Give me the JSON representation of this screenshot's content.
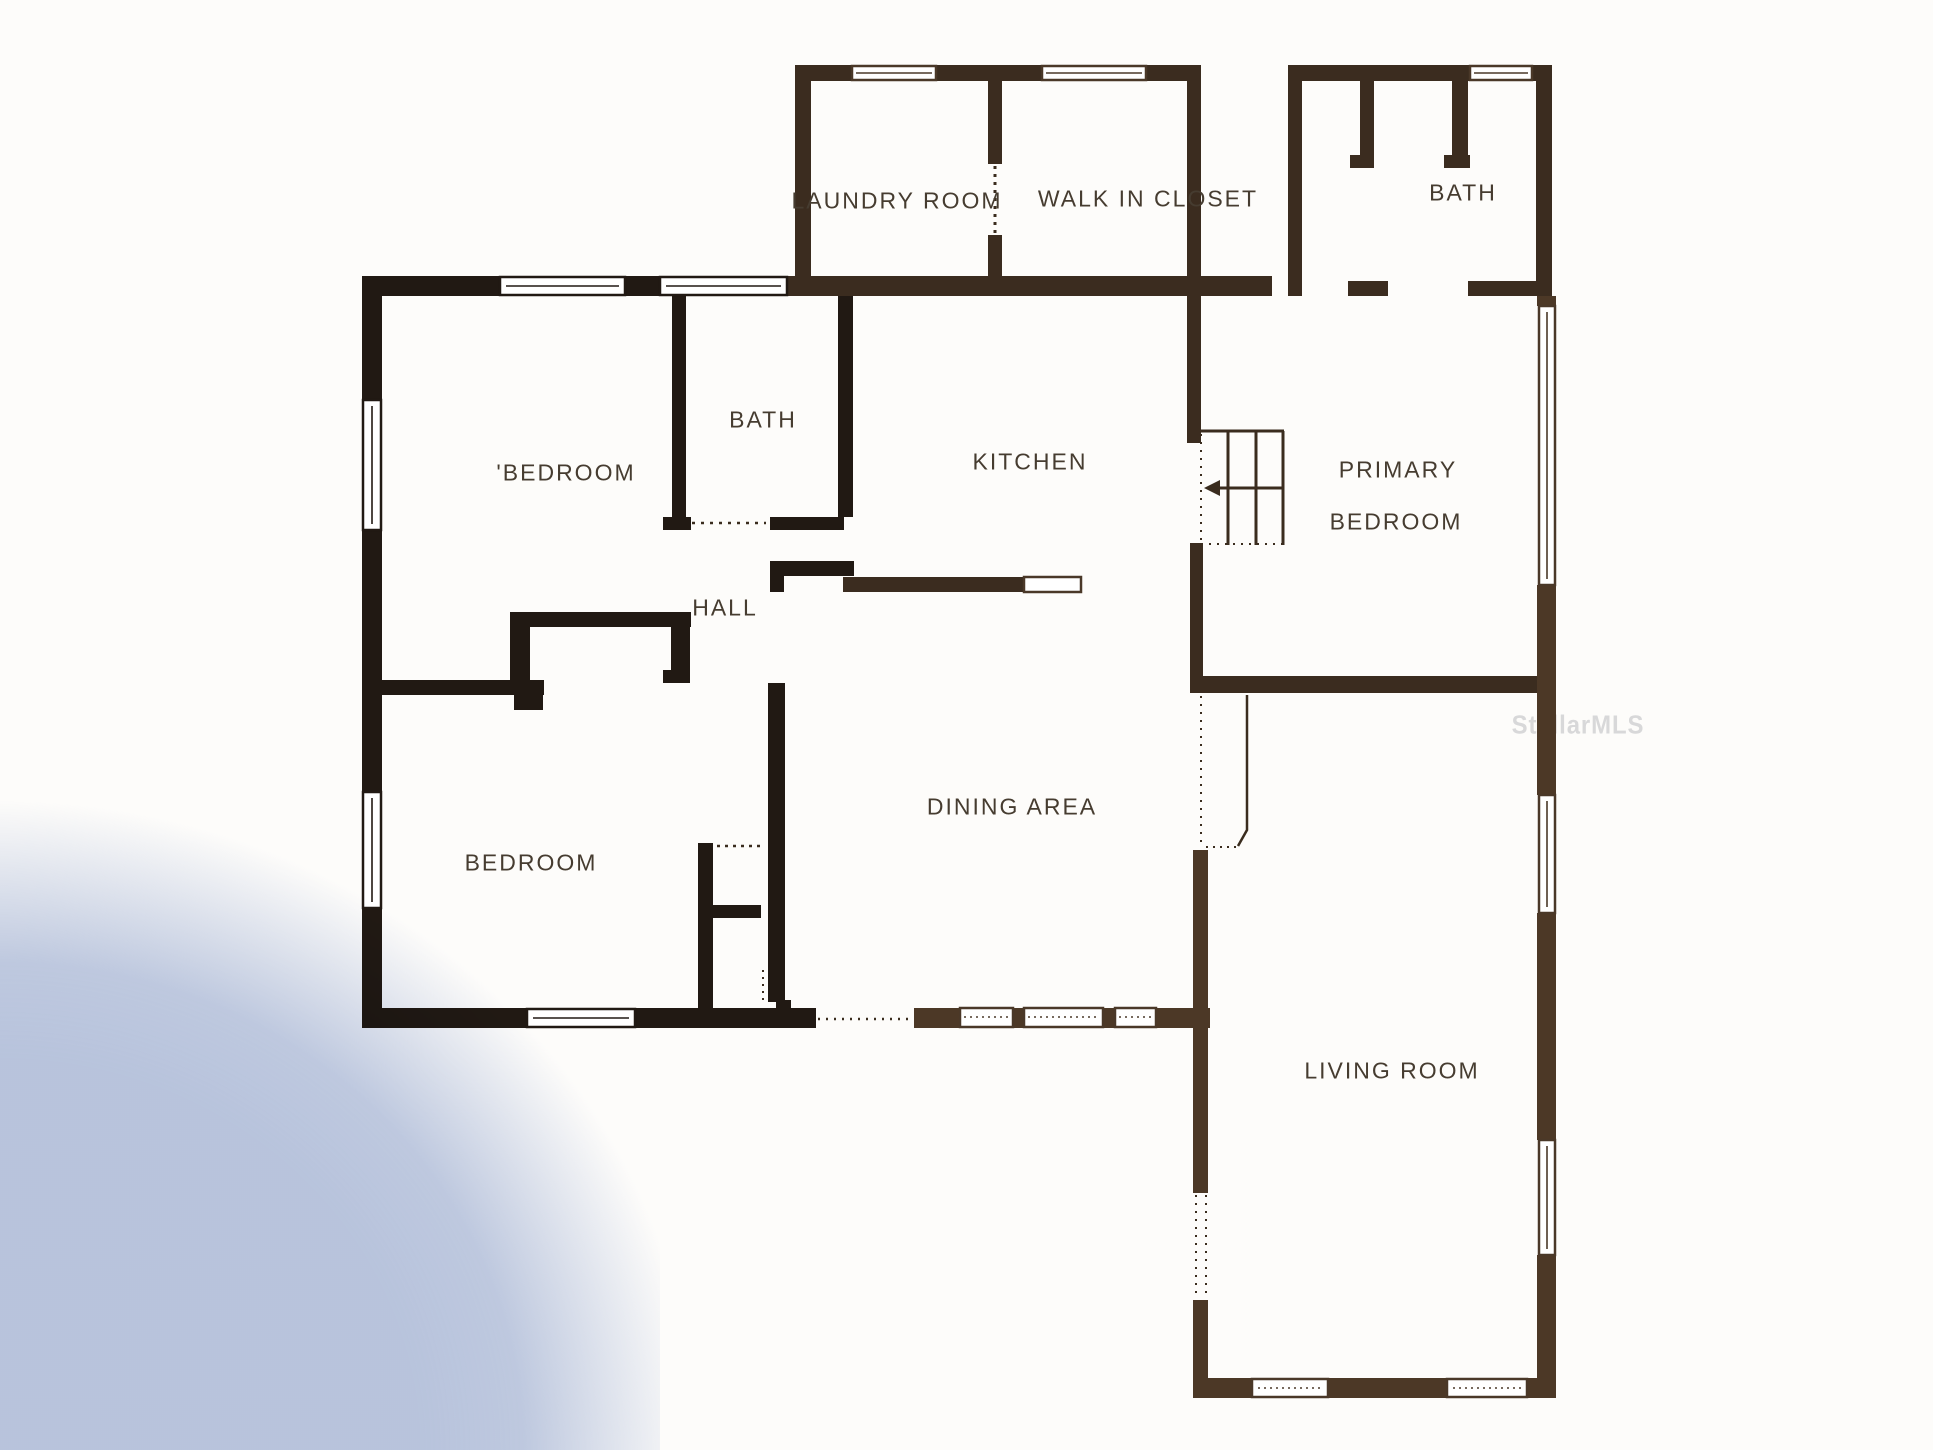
{
  "document": {
    "type": "residential-floor-plan",
    "watermark": "StellarMLS"
  },
  "rooms": {
    "laundry": {
      "label": "LAUNDRY ROOM"
    },
    "walk_in_closet": {
      "label": "WALK IN CLOSET"
    },
    "bath_upper": {
      "label": "BATH"
    },
    "bedroom_front": {
      "label": "'BEDROOM"
    },
    "bath_main": {
      "label": "BATH"
    },
    "kitchen": {
      "label": "KITCHEN"
    },
    "primary": {
      "line1": "PRIMARY",
      "line2": "BEDROOM"
    },
    "hall": {
      "label": "HALL"
    },
    "dining": {
      "label": "DINING AREA"
    },
    "bedroom_lower": {
      "label": "BEDROOM"
    },
    "living": {
      "label": "LIVING ROOM"
    }
  },
  "features": {
    "stairs_arrow_direction": "left"
  },
  "colors": {
    "wall_black": "#211913",
    "wall_brown_dark": "#3b2c1f",
    "wall_brown_light": "#4c3826",
    "label_text": "#463c30",
    "watermark_gray": "#d2d2d4",
    "shadow_blue": "#b7c4e0",
    "paper": "#fdfcfa"
  }
}
